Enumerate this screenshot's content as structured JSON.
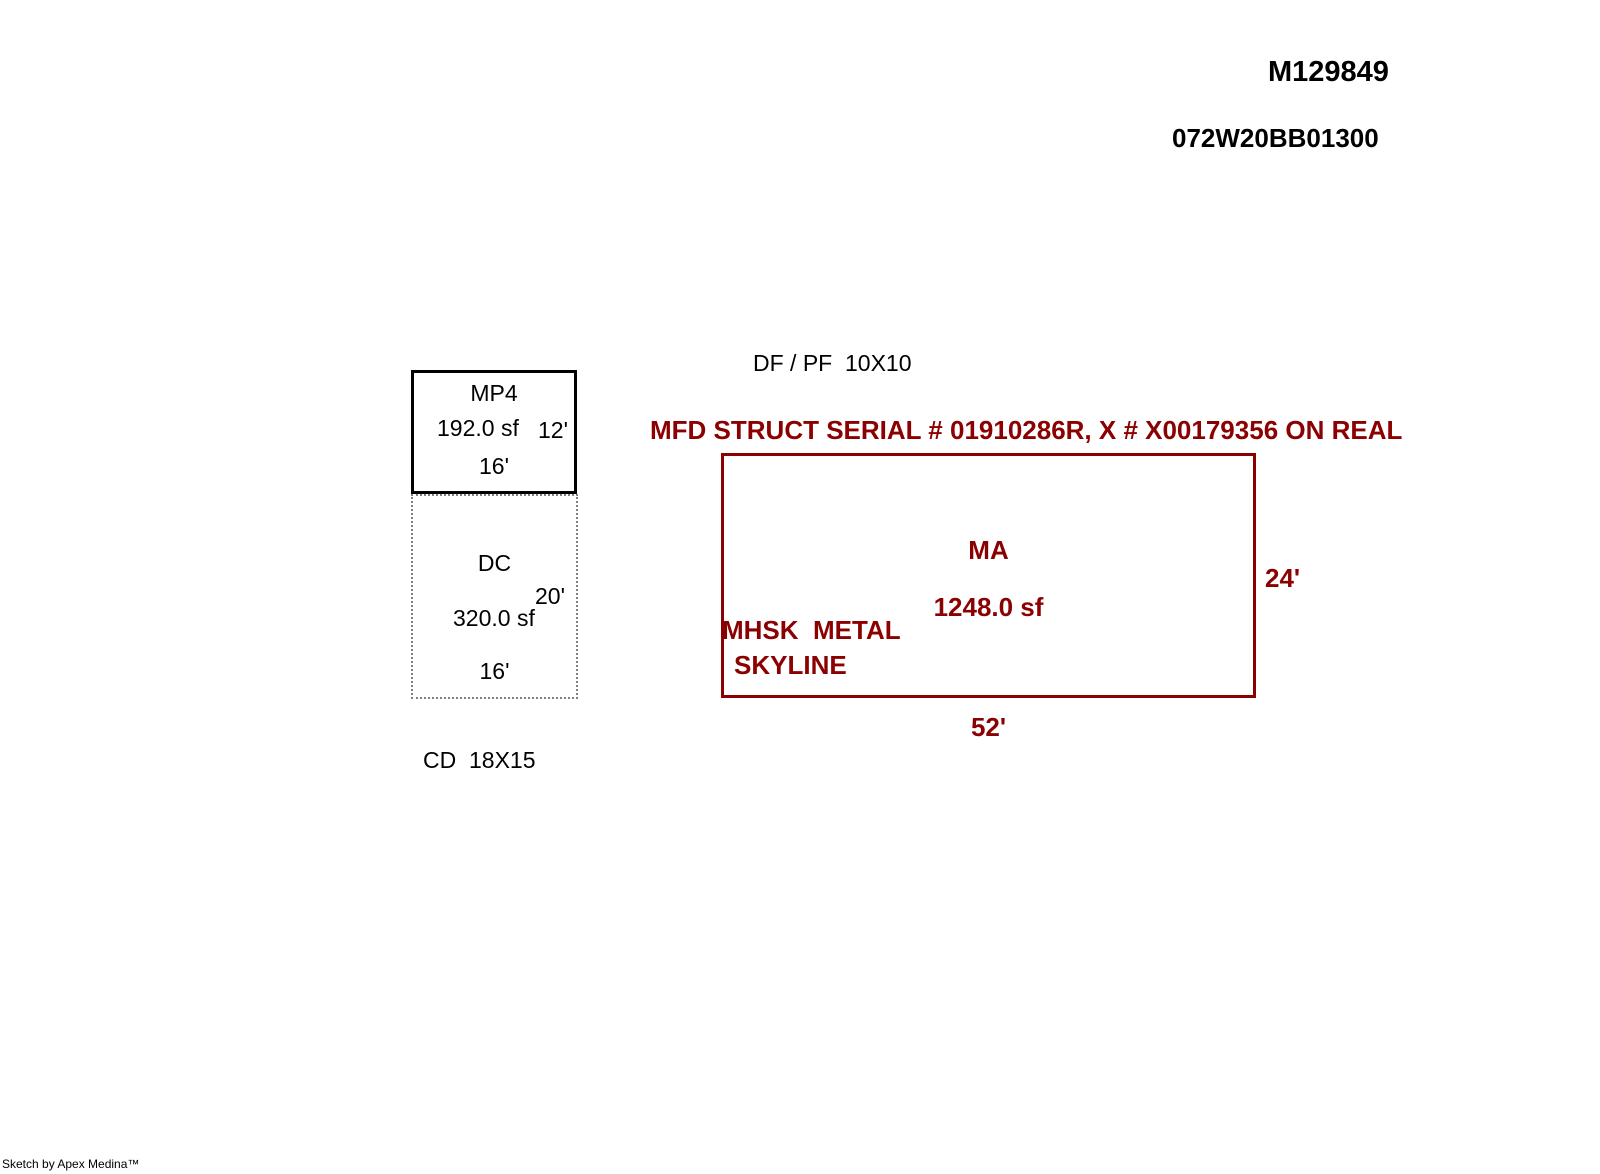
{
  "header": {
    "sketch_id": "M129849",
    "parcel_id": "072W20BB01300"
  },
  "annotations": {
    "df_pf": "DF / PF  10X10",
    "serial_note": "MFD STRUCT SERIAL # 01910286R, X # X00179356 ON REAL",
    "cd": "CD  18X15"
  },
  "structures": {
    "mp4": {
      "code": "MP4",
      "area": "192.0 sf",
      "height_dim": "12'",
      "width_dim": "16'"
    },
    "dc": {
      "code": "DC",
      "area": "320.0 sf",
      "height_dim": "20'",
      "width_dim": "16'"
    },
    "ma": {
      "code": "MA",
      "area": "1248.0 sf",
      "desc_line1": "MHSK  METAL",
      "desc_line2": "SKYLINE",
      "height_dim": "24'",
      "width_dim": "52'"
    }
  },
  "footer": {
    "credit": "Sketch by Apex Medina™"
  },
  "colors": {
    "accent_red": "#8B0000",
    "ink": "#000000",
    "dotted_gray": "#808080",
    "background": "#FFFFFF"
  }
}
